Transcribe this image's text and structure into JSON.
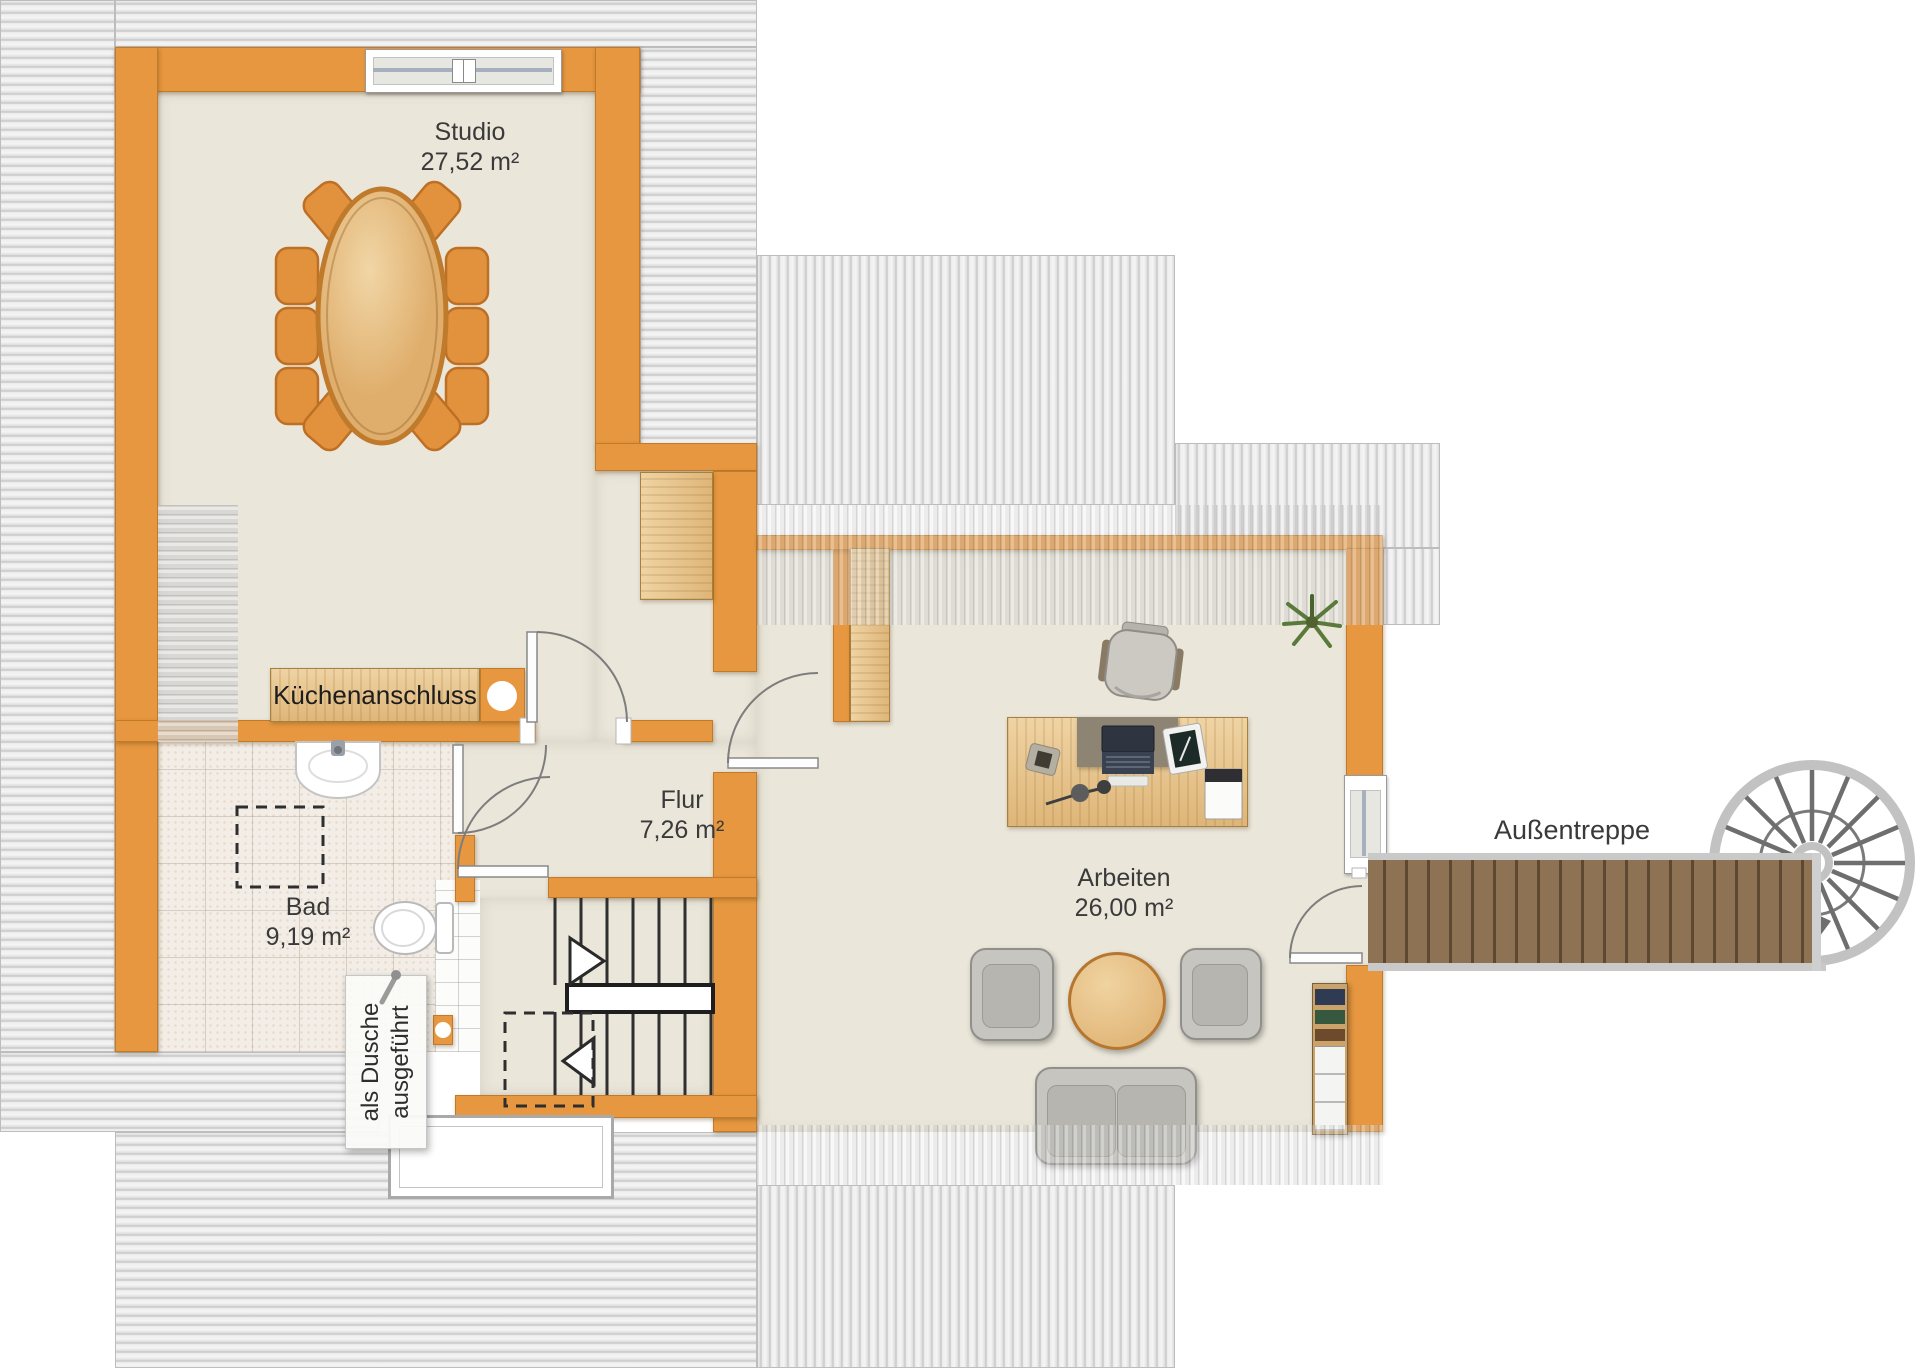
{
  "title": "Dachgeschoss Grundriss",
  "rooms": {
    "studio": {
      "name": "Studio",
      "area": "27,52 m²"
    },
    "bad": {
      "name": "Bad",
      "area": "9,19 m²"
    },
    "flur": {
      "name": "Flur",
      "area": "7,26 m²"
    },
    "arbeiten": {
      "name": "Arbeiten",
      "area": "26,00 m²"
    }
  },
  "annotations": {
    "kitchen_connection": "Küchenanschluss",
    "shower_note_line1": "als Dusche",
    "shower_note_line2": "ausgeführt",
    "exterior_stairs": "Außentreppe"
  },
  "colors": {
    "wall_orange": "#e6973f",
    "floor_beige": "#eae6da",
    "roof_hatch_gray": "#e9e9e9",
    "wood_light": "#e5c08a",
    "deck_brown": "#8d7254",
    "text": "#3a3a3a"
  }
}
